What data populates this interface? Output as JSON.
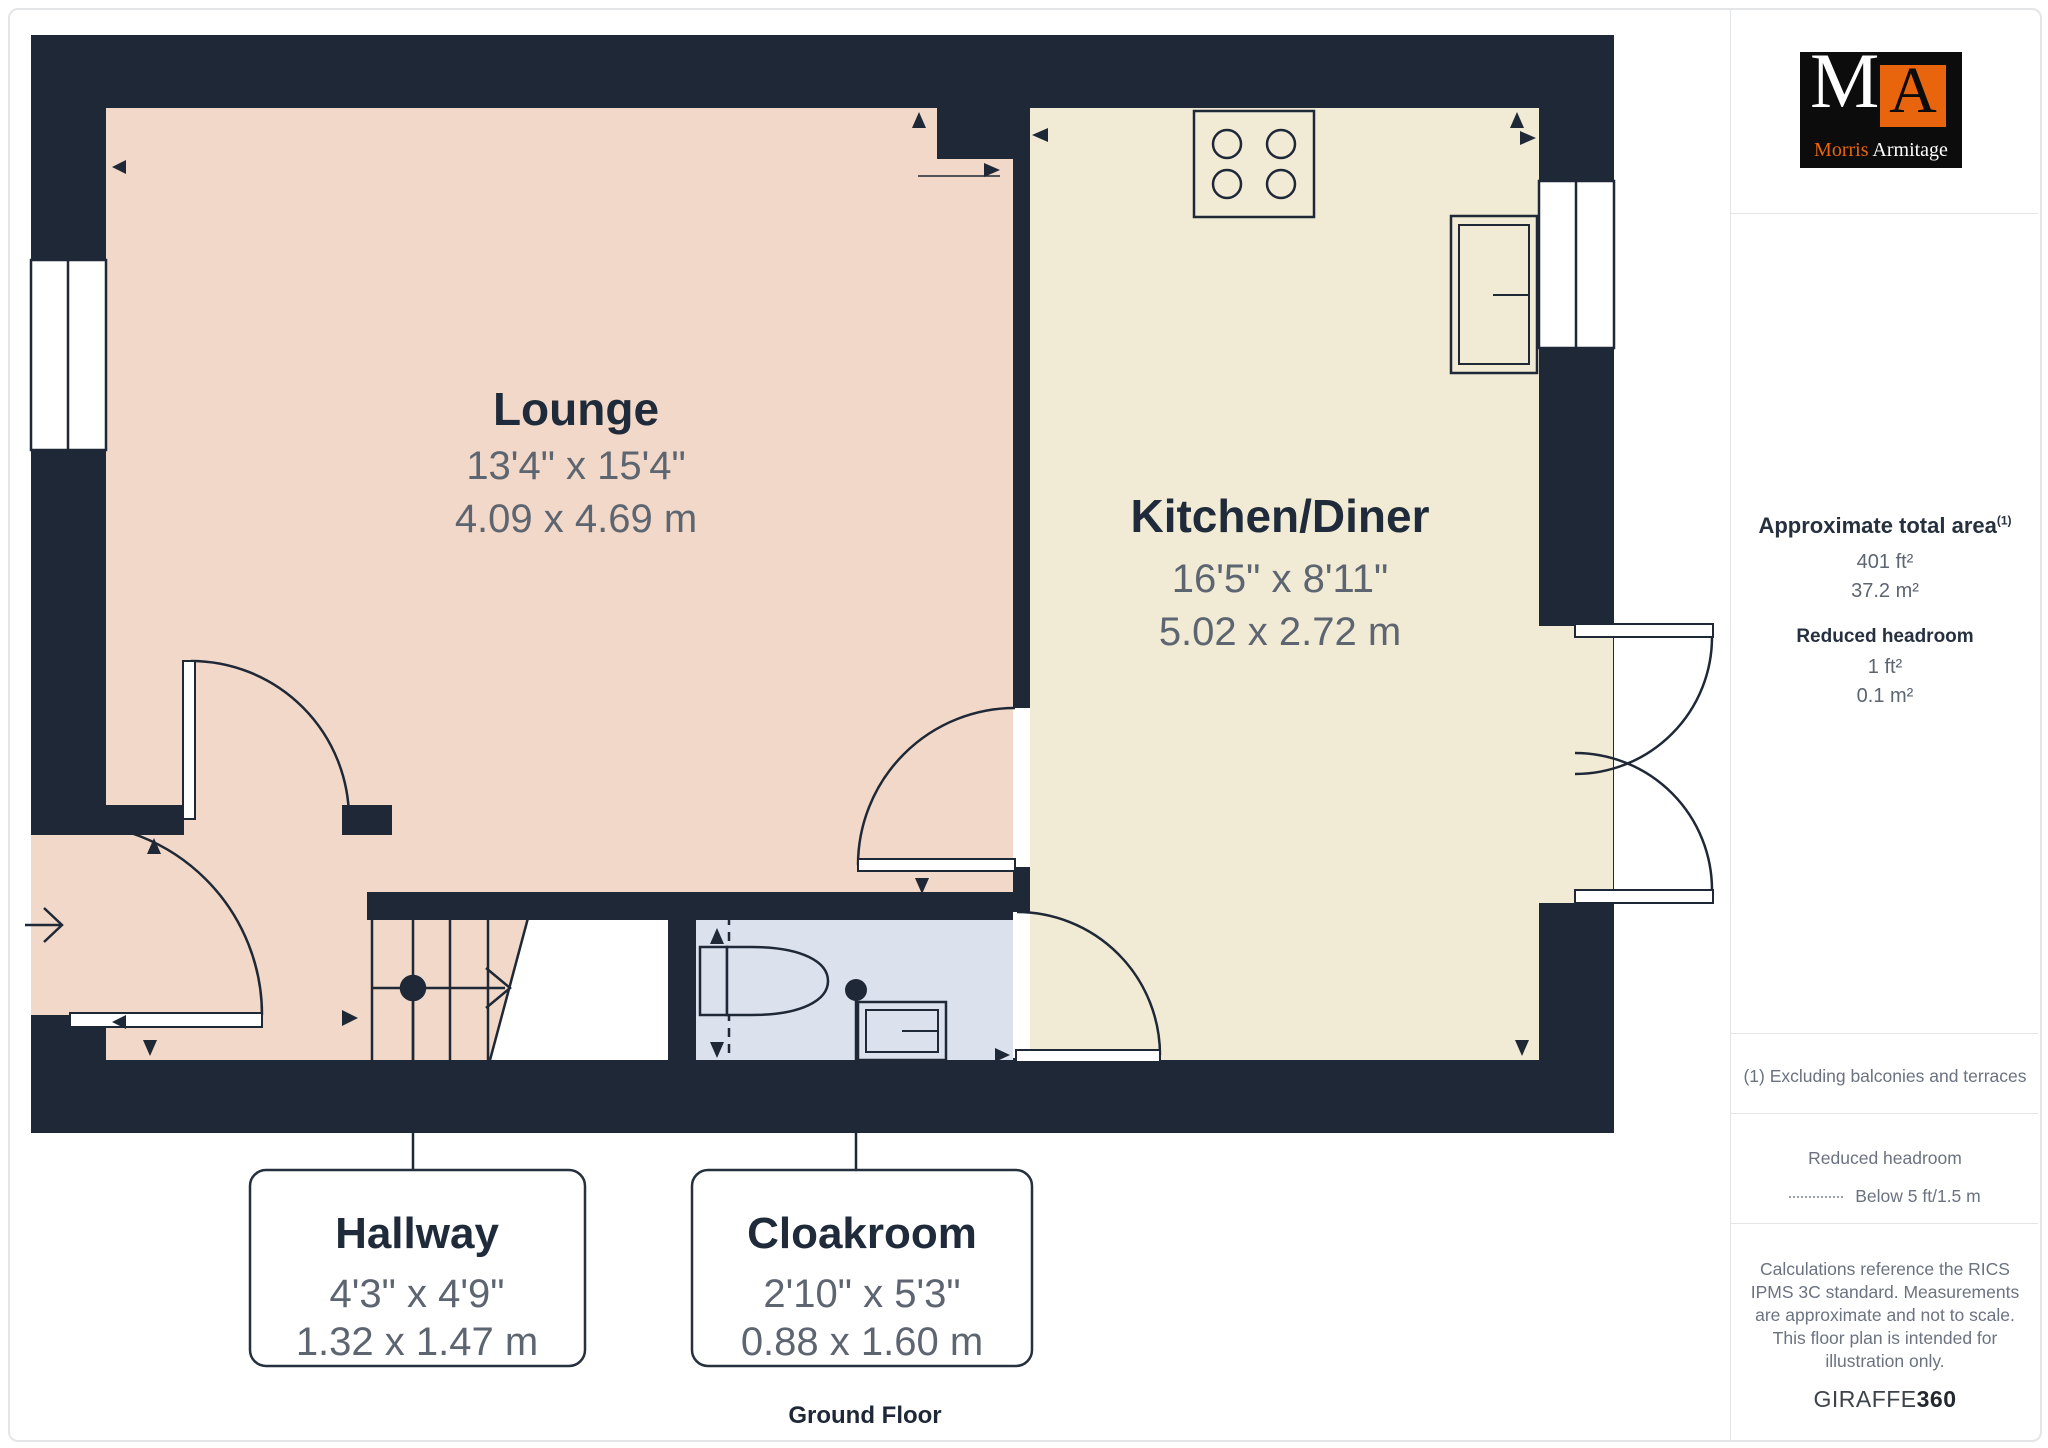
{
  "floorplan": {
    "floor_label": "Ground Floor",
    "rooms": {
      "lounge": {
        "name": "Lounge",
        "imperial": "13'4\" x 15'4\"",
        "metric": "4.09 x 4.69 m"
      },
      "kitchen": {
        "name": "Kitchen/Diner",
        "imperial": "16'5\" x 8'11\"",
        "metric": "5.02 x 2.72 m"
      }
    },
    "callouts": {
      "hallway": {
        "name": "Hallway",
        "imperial": "4'3\" x 4'9\"",
        "metric": "1.32 x 1.47 m"
      },
      "cloakroom": {
        "name": "Cloakroom",
        "imperial": "2'10\" x 5'3\"",
        "metric": "0.88 x 1.60 m"
      }
    },
    "fixtures": [
      "stove-hob",
      "kitchen-sink",
      "toilet",
      "basin",
      "staircase"
    ],
    "colors": {
      "walls": "#1e2836",
      "lounge_floor": "#f2d8c8",
      "kitchen_floor": "#f1ebd6",
      "cloakroom_floor": "#dbe1ed"
    }
  },
  "sidebar": {
    "area_title": "Approximate total area",
    "area_title_sup": "(1)",
    "area_ft": "401 ft²",
    "area_m": "37.2 m²",
    "reduced_title": "Reduced headroom",
    "reduced_ft": "1 ft²",
    "reduced_m": "0.1 m²",
    "footnote": "(1) Excluding balconies and terraces",
    "legend_title": "Reduced headroom",
    "legend_item": "Below 5 ft/1.5 m",
    "disclaimer": "Calculations reference the RICS IPMS 3C standard. Measurements are approximate and not to scale. This floor plan is intended for illustration only.",
    "brand": "GIRAFFE",
    "brand_bold": "360"
  },
  "logo": {
    "letter_m": "M",
    "letter_a": "A",
    "name_first": "Morris",
    "name_last": "Armitage"
  }
}
